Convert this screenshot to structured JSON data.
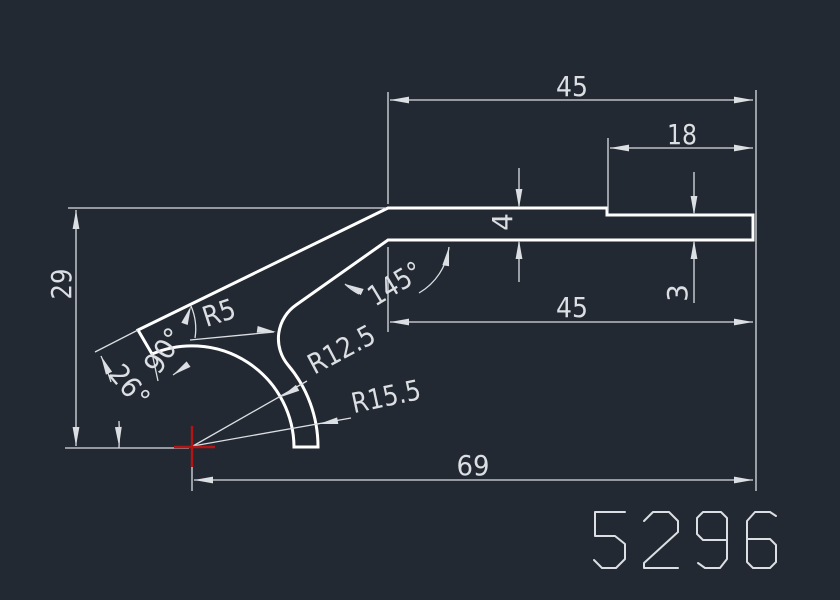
{
  "drawing": {
    "part_number": "5296",
    "dimensions": {
      "width_top": "45",
      "width_step": "18",
      "thickness_left": "4",
      "thickness_right": "3",
      "width_mid": "45",
      "height_left": "29",
      "width_total": "69",
      "angle_bend": "145°",
      "angle_end": "90°",
      "angle_arm": "26°",
      "radius_fillet": "R5",
      "radius_inner": "R12.5",
      "radius_outer": "R15.5"
    },
    "colors": {
      "background": "#232932",
      "outline": "#ffffff",
      "dimension": "#dbdfe3",
      "center_mark": "#b31414"
    }
  }
}
